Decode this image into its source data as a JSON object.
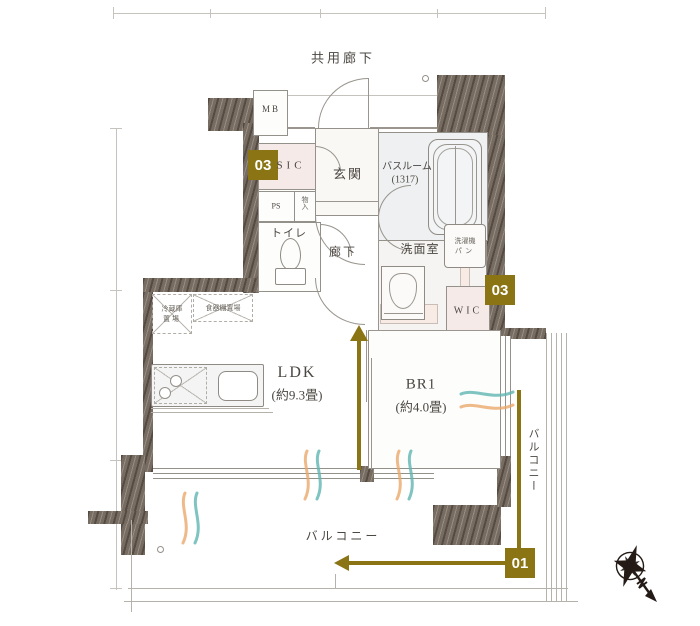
{
  "plan": {
    "common_corridor": "共用廊下",
    "mb": "MB",
    "sic": "SIC",
    "entrance": "玄関",
    "bathroom": "バスルーム",
    "bathroom_size": "(1317)",
    "ps": "PS",
    "storage": "物入",
    "toilet": "トイレ",
    "hallway": "廊下",
    "washroom": "洗面室",
    "washer_pan_line1": "洗濯機",
    "washer_pan_line2": "パン",
    "wic": "WIC",
    "fridge_space_line1": "冷蔵庫",
    "fridge_space_line2": "置場",
    "cupboard_space": "食器棚置場",
    "ldk": "LDK",
    "ldk_size": "(約9.3畳)",
    "br1": "BR1",
    "br1_size": "(約4.0畳)",
    "balcony_bottom": "バルコニー",
    "balcony_right": "バルコニー"
  },
  "markers": {
    "badge_sic": "03",
    "badge_wic": "03",
    "badge_balcony": "01"
  },
  "colors": {
    "accent_gold": "#8a7414",
    "wall": "#776c62",
    "airflow_teal": "#5fb5b1",
    "airflow_orange": "#eba96b"
  }
}
